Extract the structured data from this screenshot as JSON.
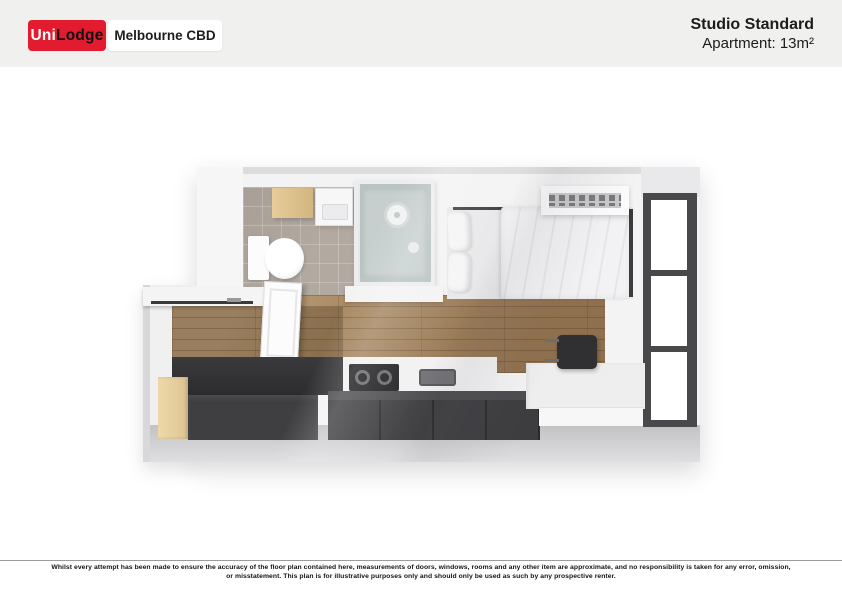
{
  "header": {
    "brand": {
      "uni": "Uni",
      "lodge": "Lodge",
      "location": "Melbourne CBD"
    },
    "plan_title": "Studio Standard",
    "plan_subtitle": "Apartment: 13m²"
  },
  "floorplan": {
    "type": "3d-top-down-render",
    "rooms": [
      "bathroom",
      "sleeping-area",
      "kitchen",
      "study-desk-area",
      "entry"
    ],
    "furniture": [
      "storage-cabinet",
      "vanity-basin",
      "toilet",
      "shower-enclosure",
      "bed",
      "pillows",
      "duvet",
      "air-conditioner",
      "window-door",
      "timber-floor",
      "tiled-floor",
      "kitchen-bench",
      "cooktop",
      "kitchen-sink",
      "island-cabinets",
      "timber-end-panel",
      "desk",
      "office-chair",
      "entry-door",
      "entry-shelf"
    ]
  },
  "colors": {
    "brand_red": "#e21b2e",
    "header_bg": "#f0f0ee",
    "text_dark": "#1c1c1a",
    "wall_light": "#f3f3f4",
    "wall_gray": "#c8c8ca",
    "wood_floor": "#a3835c",
    "tile_floor": "#b2a9a1",
    "cabinet_dark": "#3d3d40",
    "timber_light": "#ead4a6",
    "shower_glass": "#b9c3c2",
    "window_frame": "#49494c"
  },
  "footer": {
    "disclaimer_line1": "Whilst every attempt has been made to ensure the accuracy of the floor plan contained here, measurements of doors, windows, rooms and any other item are approximate, and no responsibility is taken for any error, omission,",
    "disclaimer_line2": "or misstatement. This plan is for illustrative purposes only and should only be used as such by any prospective renter."
  }
}
